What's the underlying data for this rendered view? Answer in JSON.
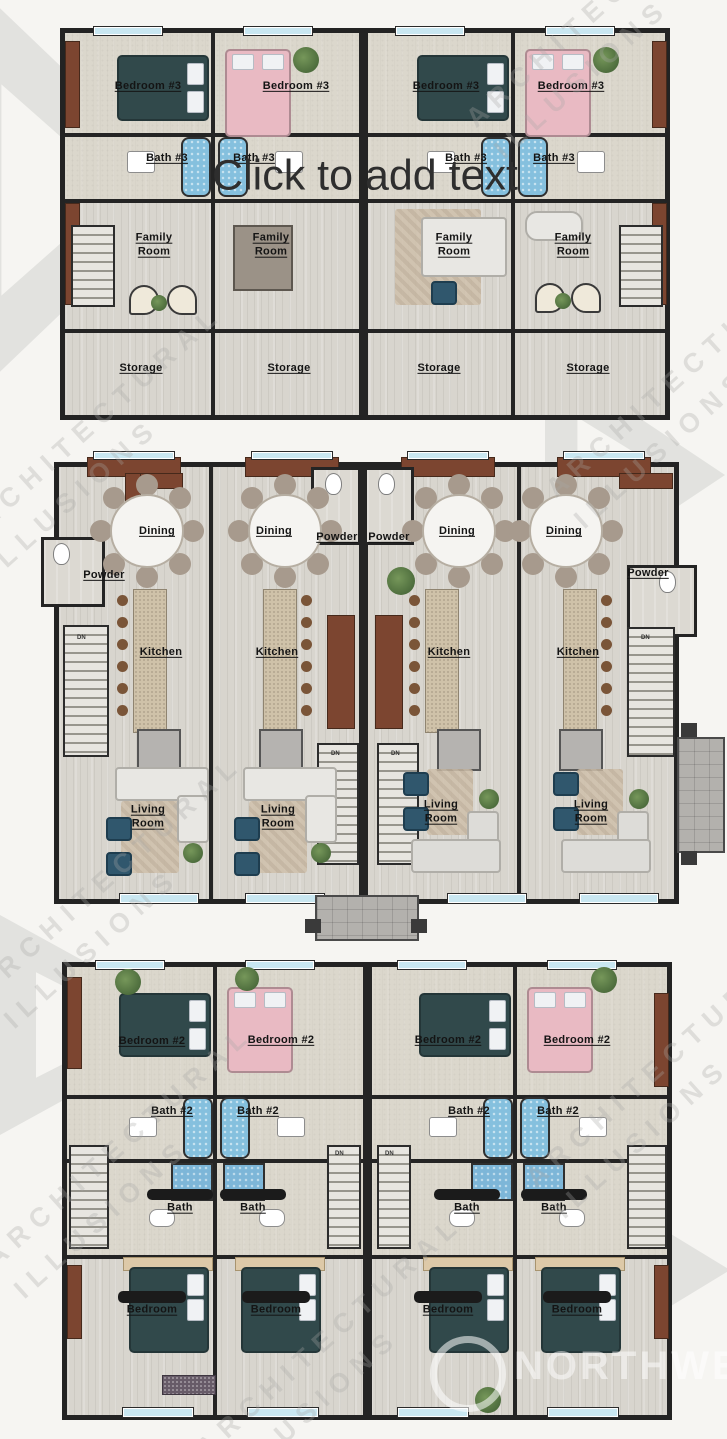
{
  "editor": {
    "placeholder": "Click to add text"
  },
  "watermark": {
    "line1": "ARCHITECTURAL",
    "line2": "ILLUSIONS",
    "brand": "NORTHWEST"
  },
  "misc": {
    "up": "UP",
    "dn": "DN"
  },
  "plans": [
    {
      "units": [
        {
          "bedroom": "Bedroom #3",
          "bath": "Bath #3",
          "family": [
            "Family",
            "Room"
          ],
          "storage": "Storage"
        },
        {
          "bedroom": "Bedroom #3",
          "bath": "Bath #3",
          "family": [
            "Family",
            "Room"
          ],
          "storage": "Storage"
        },
        {
          "bedroom": "Bedroom #3",
          "bath": "Bath #3",
          "family": [
            "Family",
            "Room"
          ],
          "storage": "Storage"
        },
        {
          "bedroom": "Bedroom #3",
          "bath": "Bath #3",
          "family": [
            "Family",
            "Room"
          ],
          "storage": "Storage"
        }
      ]
    },
    {
      "units": [
        {
          "dining": "Dining",
          "powder": "Powder",
          "kitchen": "Kitchen",
          "living": [
            "Living",
            "Room"
          ]
        },
        {
          "dining": "Dining",
          "powder": "Powder",
          "kitchen": "Kitchen",
          "living": [
            "Living",
            "Room"
          ]
        },
        {
          "dining": "Dining",
          "powder": "Powder",
          "kitchen": "Kitchen",
          "living": [
            "Living",
            "Room"
          ]
        },
        {
          "dining": "Dining",
          "powder": "Powder",
          "kitchen": "Kitchen",
          "living": [
            "Living",
            "Room"
          ]
        }
      ]
    },
    {
      "units": [
        {
          "bedroom": "Bedroom #2",
          "bath": "Bath #2",
          "master_bath": [
            "Master",
            "Bath"
          ],
          "master_bedroom": [
            "Master",
            "Bedroom"
          ]
        },
        {
          "bedroom": "Bedroom #2",
          "bath": "Bath #2",
          "master_bath": [
            "Master",
            "Bath"
          ],
          "master_bedroom": [
            "Master",
            "Bedroom"
          ]
        },
        {
          "bedroom": "Bedroom #2",
          "bath": "Bath #2",
          "master_bath": [
            "Master",
            "Bath"
          ],
          "master_bedroom": [
            "Master",
            "Bedroom"
          ]
        },
        {
          "bedroom": "Bedroom #2",
          "bath": "Bath #2",
          "master_bath": [
            "Master",
            "Bath"
          ],
          "master_bedroom": [
            "Master",
            "Bedroom"
          ]
        }
      ]
    }
  ]
}
